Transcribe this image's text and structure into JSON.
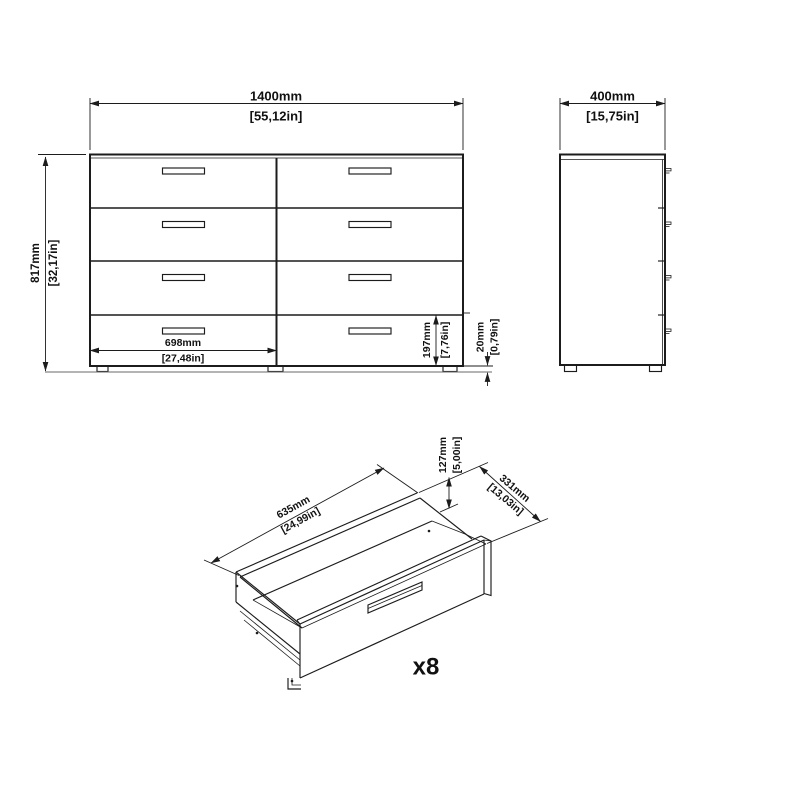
{
  "colors": {
    "line": "#1c1c1c",
    "text": "#111111",
    "background": "#ffffff",
    "ground_line": "#6a6a6a"
  },
  "front_view": {
    "drawer_rows": 4,
    "drawer_columns": 2,
    "drawer_count": 8,
    "feet_count": 3,
    "width": {
      "mm": "1400mm",
      "inches": "[55,12in]"
    },
    "height": {
      "mm": "817mm",
      "inches": "[32,17in]"
    },
    "drawer_width": {
      "mm": "698mm",
      "inches": "[27,48in]"
    },
    "bottom_drawer_height": {
      "mm": "197mm",
      "inches": "[7,76in]"
    },
    "foot_height": {
      "mm": "20mm",
      "inches": "[0,79in]"
    }
  },
  "side_view": {
    "handle_count": 4,
    "feet_count": 2,
    "depth": {
      "mm": "400mm",
      "inches": "[15,75in]"
    }
  },
  "drawer_detail_view": {
    "width": {
      "mm": "635mm",
      "inches": "[24,99in]"
    },
    "height": {
      "mm": "127mm",
      "inches": "[5,00in]"
    },
    "depth": {
      "mm": "331mm",
      "inches": "[13,03in]"
    },
    "quantity": "x8"
  }
}
